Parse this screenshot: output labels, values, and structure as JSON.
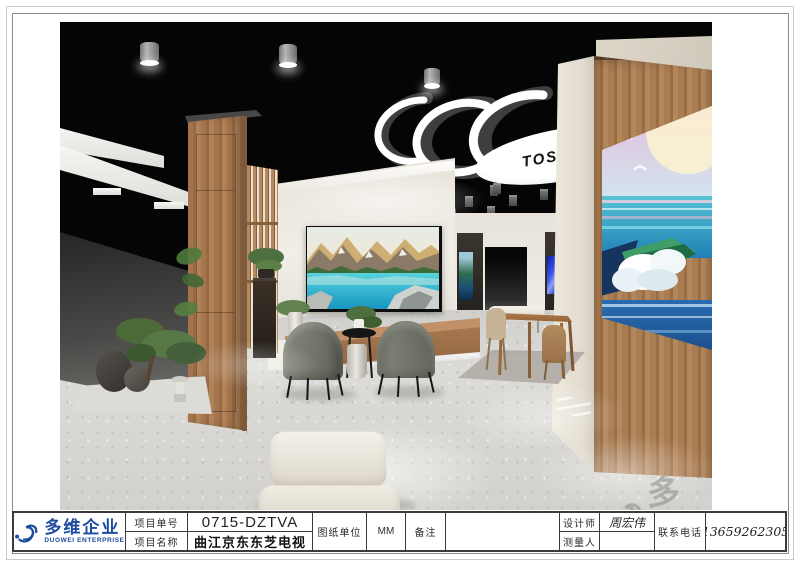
{
  "title_block": {
    "logo": {
      "company_cn": "多维企业",
      "company_en": "DUOWEI ENTERPRISE"
    },
    "fields": {
      "project_no_label": "项目单号",
      "project_no": "0715-DZTVA",
      "project_name_label": "项目名称",
      "project_name": "曲江京东东芝电视",
      "unit_label": "图纸单位",
      "unit": "MM",
      "remark_label": "备注",
      "remark": "",
      "designer_label": "设计师",
      "designer": "周宏伟",
      "surveyor_label": "测量人",
      "surveyor": "",
      "phone_label": "联系电话",
      "phone": "13659262305"
    }
  },
  "scene": {
    "ceiling_brand": "TOSHIBA",
    "watermark_text": "多维",
    "colors": {
      "brand_blue": "#1d4ba0",
      "ceiling_black": "#050505",
      "wood": "#a5754e",
      "wall_cream": "#e9e4db",
      "chair_olive": "#787b6e",
      "floor_terrazzo": "#d5d4d0"
    }
  }
}
